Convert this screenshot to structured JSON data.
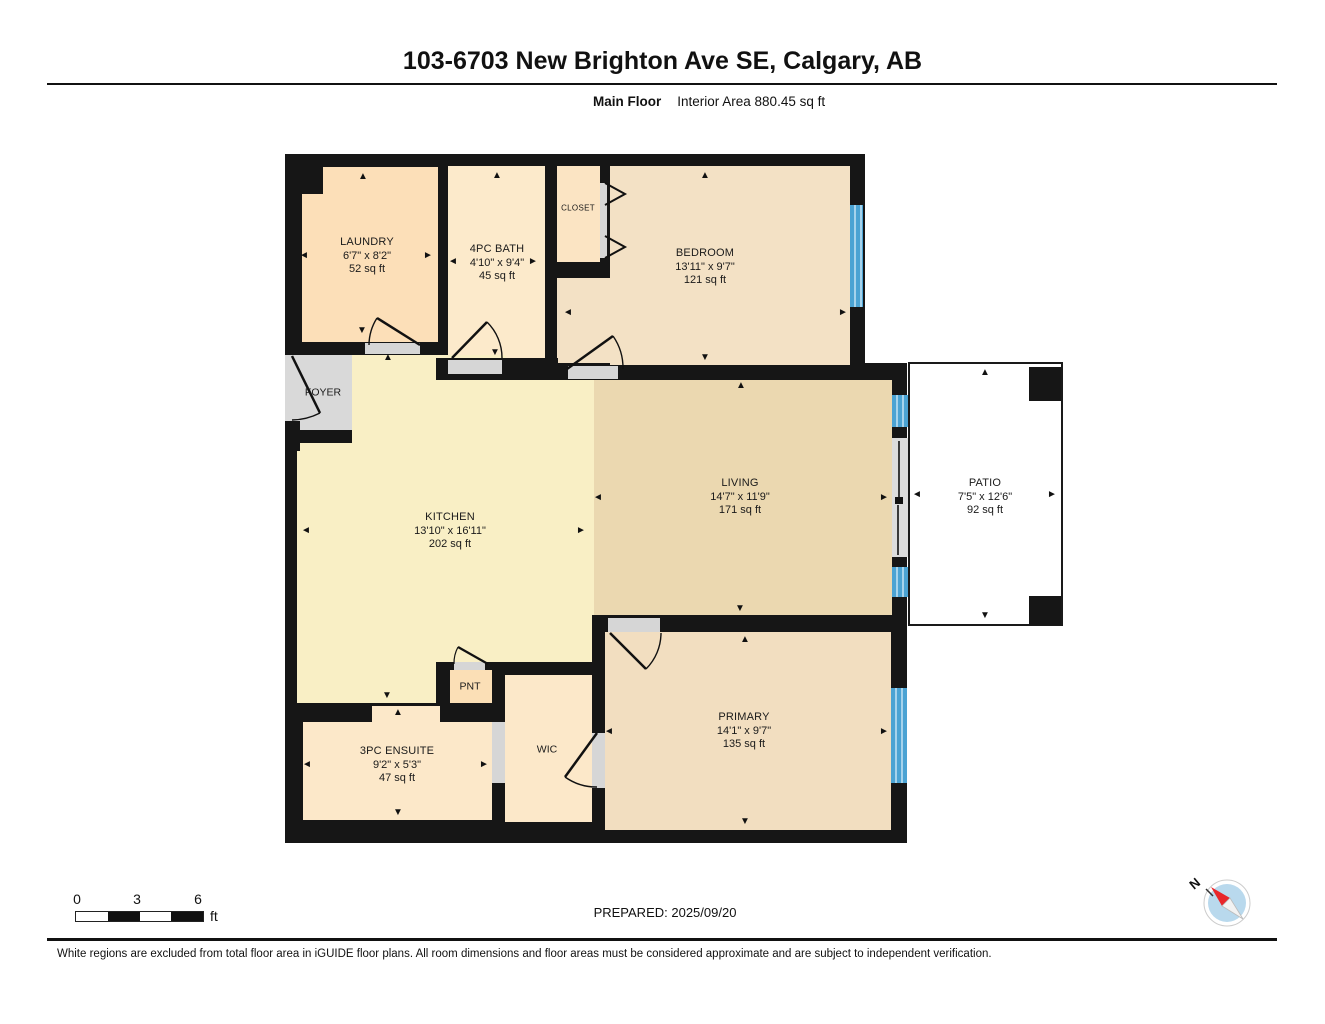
{
  "header": {
    "title": "103-6703 New Brighton Ave SE, Calgary, AB",
    "floor_label": "Main Floor",
    "interior_area_label": "Interior Area 880.45 sq ft"
  },
  "plan": {
    "rooms": [
      {
        "name": "LAUNDRY",
        "dims": "6'7\" x 8'2\"",
        "area": "52 sq ft"
      },
      {
        "name": "4PC BATH",
        "dims": "4'10\" x 9'4\"",
        "area": "45 sq ft"
      },
      {
        "name": "CLOSET"
      },
      {
        "name": "BEDROOM",
        "dims": "13'11\" x 9'7\"",
        "area": "121 sq ft"
      },
      {
        "name": "FOYER"
      },
      {
        "name": "KITCHEN",
        "dims": "13'10\" x 16'11\"",
        "area": "202 sq ft"
      },
      {
        "name": "LIVING",
        "dims": "14'7\" x 11'9\"",
        "area": "171 sq ft"
      },
      {
        "name": "PATIO",
        "dims": "7'5\" x 12'6\"",
        "area": "92 sq ft"
      },
      {
        "name": "PNT"
      },
      {
        "name": "3PC ENSUITE",
        "dims": "9'2\" x 5'3\"",
        "area": "47 sq ft"
      },
      {
        "name": "WIC"
      },
      {
        "name": "PRIMARY",
        "dims": "14'1\" x 9'7\"",
        "area": "135 sq ft"
      }
    ],
    "colors": {
      "wall": "#161616",
      "window_blue": "#4ba3d3",
      "window_stripe": "#a6d3ec",
      "laundry": "#fcdfb8",
      "bath": "#fceacb",
      "closet": "#fbe4c3",
      "bedroom": "#f3e1c5",
      "kitchen": "#f9efc5",
      "living": "#ebd8b0",
      "primary": "#f2dec0",
      "ensuite": "#fce8c9",
      "pantry": "#fbdfb6",
      "foyer": "#d9d9d9",
      "patio": "#ffffff"
    },
    "arrows": [
      {
        "x": 363,
        "y": 177,
        "d": "up"
      },
      {
        "x": 304,
        "y": 256,
        "d": "left"
      },
      {
        "x": 428,
        "y": 256,
        "d": "right"
      },
      {
        "x": 362,
        "y": 331,
        "d": "down"
      },
      {
        "x": 497,
        "y": 176,
        "d": "up"
      },
      {
        "x": 453,
        "y": 262,
        "d": "left"
      },
      {
        "x": 533,
        "y": 262,
        "d": "right"
      },
      {
        "x": 495,
        "y": 353,
        "d": "down"
      },
      {
        "x": 705,
        "y": 176,
        "d": "up"
      },
      {
        "x": 568,
        "y": 313,
        "d": "left"
      },
      {
        "x": 843,
        "y": 313,
        "d": "right"
      },
      {
        "x": 705,
        "y": 358,
        "d": "down"
      },
      {
        "x": 388,
        "y": 358,
        "d": "up"
      },
      {
        "x": 306,
        "y": 531,
        "d": "left"
      },
      {
        "x": 581,
        "y": 531,
        "d": "right"
      },
      {
        "x": 387,
        "y": 696,
        "d": "down"
      },
      {
        "x": 741,
        "y": 386,
        "d": "up"
      },
      {
        "x": 598,
        "y": 498,
        "d": "left"
      },
      {
        "x": 884,
        "y": 498,
        "d": "right"
      },
      {
        "x": 740,
        "y": 609,
        "d": "down"
      },
      {
        "x": 985,
        "y": 373,
        "d": "up"
      },
      {
        "x": 917,
        "y": 495,
        "d": "left"
      },
      {
        "x": 1052,
        "y": 495,
        "d": "right"
      },
      {
        "x": 985,
        "y": 616,
        "d": "down"
      },
      {
        "x": 745,
        "y": 640,
        "d": "up"
      },
      {
        "x": 609,
        "y": 732,
        "d": "left"
      },
      {
        "x": 884,
        "y": 732,
        "d": "right"
      },
      {
        "x": 745,
        "y": 822,
        "d": "down"
      },
      {
        "x": 398,
        "y": 713,
        "d": "up"
      },
      {
        "x": 307,
        "y": 765,
        "d": "left"
      },
      {
        "x": 484,
        "y": 765,
        "d": "right"
      },
      {
        "x": 398,
        "y": 813,
        "d": "down"
      }
    ]
  },
  "footer": {
    "scale": {
      "tick0": "0",
      "tick1": "3",
      "tick2": "6",
      "unit": "ft"
    },
    "prepared": "PREPARED: 2025/09/20",
    "compass_north": "N",
    "disclaimer": "White regions are excluded from total floor area in iGUIDE floor plans. All room dimensions and floor areas must be considered approximate and are subject to independent verification."
  }
}
